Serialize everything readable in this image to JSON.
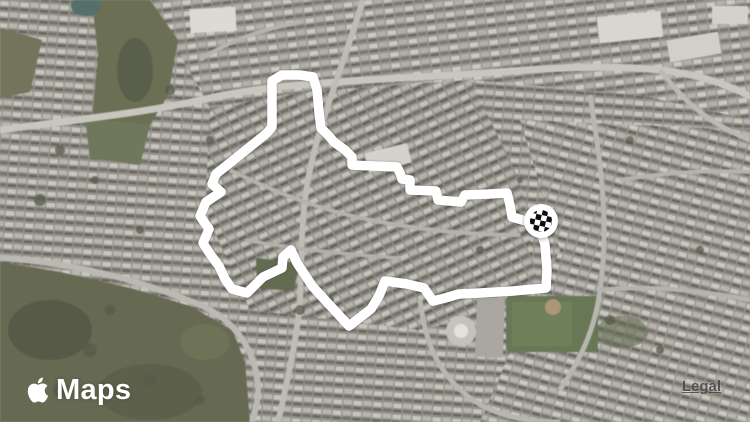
{
  "map": {
    "view": "satellite",
    "attribution": {
      "provider_label": "Maps",
      "legal_label": "Legal"
    }
  },
  "route": {
    "color": "#ffffff",
    "stroke_width": 9.5,
    "points": [
      [
        541,
        231
      ],
      [
        545,
        245
      ],
      [
        547,
        270
      ],
      [
        546,
        288
      ],
      [
        513,
        291
      ],
      [
        480,
        293
      ],
      [
        459,
        294
      ],
      [
        445,
        298
      ],
      [
        433,
        301
      ],
      [
        424,
        288
      ],
      [
        407,
        284
      ],
      [
        385,
        281
      ],
      [
        379,
        296
      ],
      [
        371,
        309
      ],
      [
        349,
        326
      ],
      [
        313,
        287
      ],
      [
        297,
        263
      ],
      [
        291,
        250
      ],
      [
        283,
        257
      ],
      [
        282,
        268
      ],
      [
        263,
        277
      ],
      [
        247,
        293
      ],
      [
        232,
        289
      ],
      [
        225,
        279
      ],
      [
        219,
        266
      ],
      [
        210,
        254
      ],
      [
        203,
        243
      ],
      [
        209,
        229
      ],
      [
        200,
        216
      ],
      [
        206,
        202
      ],
      [
        221,
        192
      ],
      [
        212,
        184
      ],
      [
        216,
        174
      ],
      [
        231,
        162
      ],
      [
        251,
        146
      ],
      [
        267,
        133
      ],
      [
        272,
        127
      ],
      [
        272,
        98
      ],
      [
        272,
        81
      ],
      [
        282,
        75
      ],
      [
        300,
        75
      ],
      [
        313,
        77
      ],
      [
        317,
        90
      ],
      [
        319,
        112
      ],
      [
        321,
        128
      ],
      [
        328,
        135
      ],
      [
        334,
        142
      ],
      [
        345,
        150
      ],
      [
        352,
        157
      ],
      [
        352,
        165
      ],
      [
        373,
        166
      ],
      [
        397,
        167
      ],
      [
        400,
        173
      ],
      [
        402,
        179
      ],
      [
        410,
        180
      ],
      [
        410,
        190
      ],
      [
        436,
        191
      ],
      [
        438,
        200
      ],
      [
        461,
        202
      ],
      [
        465,
        195
      ],
      [
        489,
        194
      ],
      [
        507,
        193
      ],
      [
        510,
        205
      ],
      [
        512,
        217
      ],
      [
        526,
        221
      ],
      [
        536,
        224
      ]
    ],
    "finish_marker": {
      "style": "checkered-flag",
      "x": 541,
      "y": 221,
      "outer_radius": 17,
      "checker_radius": 11,
      "fill": "#ffffff",
      "checker_color": "#0d0d0d"
    }
  }
}
